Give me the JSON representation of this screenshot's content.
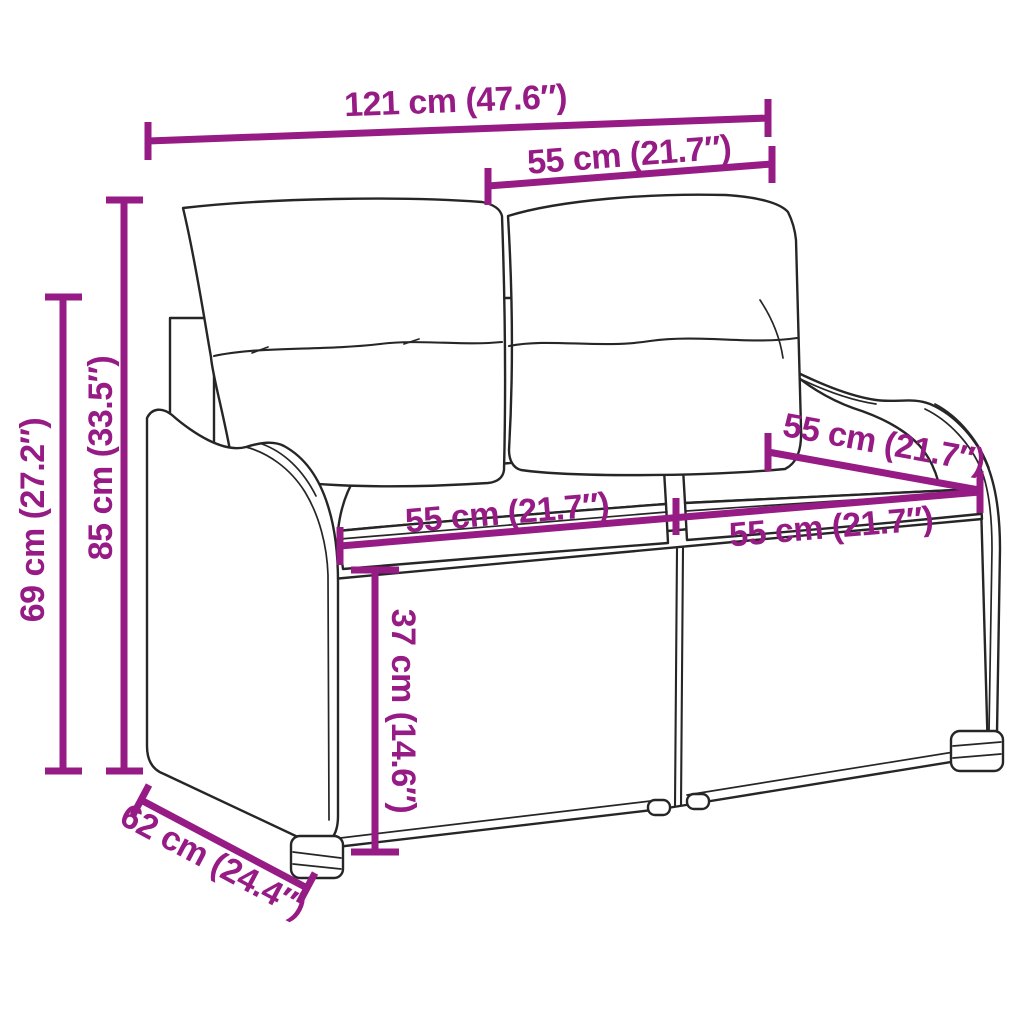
{
  "diagram": {
    "type": "product dimension diagram",
    "subject": "poly rattan 2-seater garden bench with back and seat cushions"
  },
  "colors": {
    "dimension_accent": "#961B85",
    "line_art": "#262626",
    "background": "#FFFFFF"
  },
  "dimensions": {
    "overall_width": "121 cm (47.6″)",
    "back_width_top": "55 cm (21.7″)",
    "back_height": "85 cm (33.5″)",
    "armrest_height": "69 cm (27.2″)",
    "seat_depth": "55 cm (21.7″)",
    "seat_width_left": "55 cm (21.7″)",
    "seat_width_right": "55 cm (21.7″)",
    "seat_height": "37 cm (14.6″)",
    "overall_depth": "62 cm (24.4″)"
  }
}
